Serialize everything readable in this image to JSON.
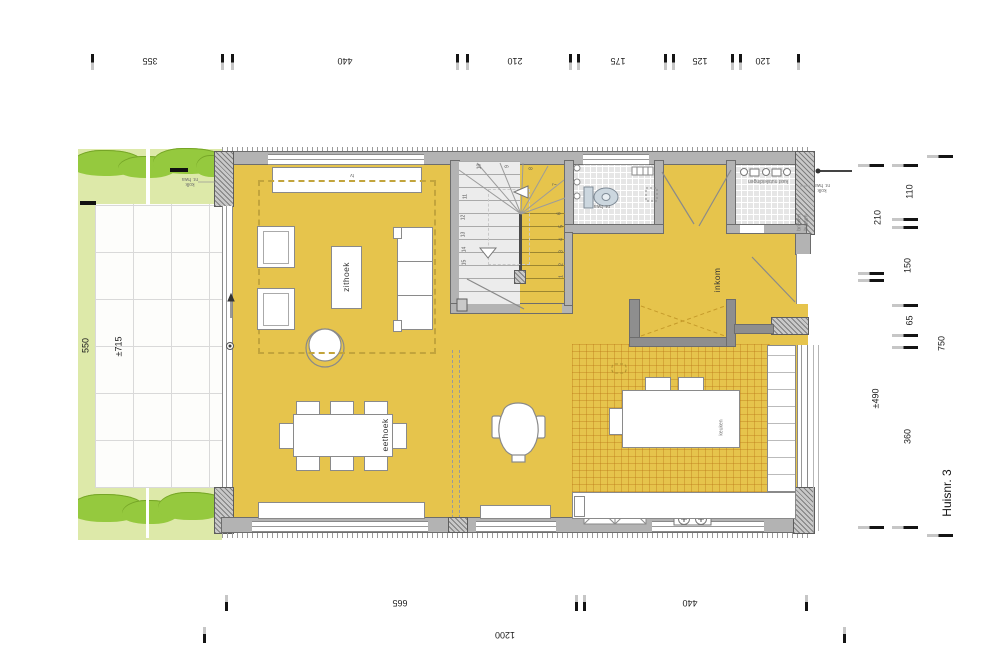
{
  "title": "Huisnr. 3",
  "rooms": {
    "living": "zithoek",
    "dining": "eethoek",
    "entry": "inkom"
  },
  "labels": {
    "tv": "tv",
    "island": "keuken",
    "meter_closet": "kast nutsleidingen",
    "mailbox_l1": "brieven",
    "mailbox_l2": "bussen",
    "drain_l1": "kolk",
    "drain_l2": "nr. hwa"
  },
  "dimensions": {
    "top": [
      "355",
      "440",
      "210",
      "175",
      "125",
      "120"
    ],
    "bottom": [
      "665",
      "440",
      "1200"
    ],
    "left": [
      "550",
      "±715"
    ],
    "right": [
      "110",
      "210",
      "150",
      "65",
      "750",
      "±490",
      "360"
    ]
  },
  "stair": {
    "step_numbers": [
      "1",
      "2",
      "3",
      "4",
      "5",
      "6",
      "7",
      "8",
      "9",
      "10",
      "11",
      "12",
      "13",
      "14",
      "15"
    ]
  }
}
